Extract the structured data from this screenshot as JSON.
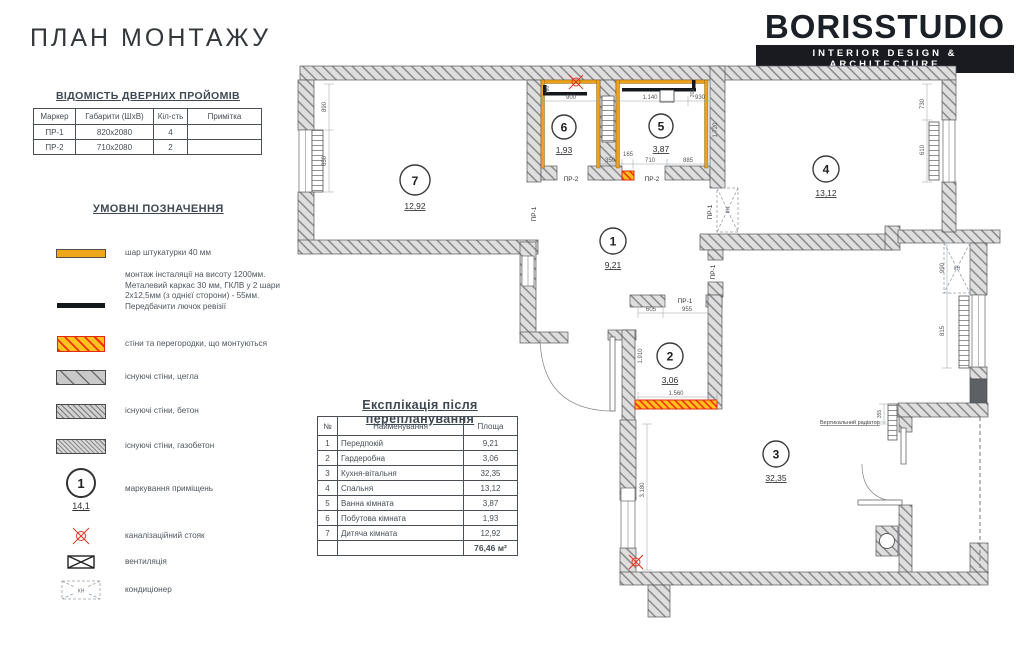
{
  "page": {
    "title": "ПЛАН МОНТАЖУ"
  },
  "logo": {
    "name": "BORISSTUDIO",
    "tagline": "INTERIOR DESIGN & ARCHITECTURE"
  },
  "door_schedule": {
    "title": "ВІДОМІСТЬ ДВЕРНИХ ПРОЙОМІВ",
    "headers": [
      "Маркер",
      "Габарити (ШхВ)",
      "Кіл-сть",
      "Примітка"
    ],
    "rows": [
      {
        "marker": "ПР-1",
        "size": "820х2080",
        "qty": "4",
        "note": ""
      },
      {
        "marker": "ПР-2",
        "size": "710х2080",
        "qty": "2",
        "note": ""
      }
    ]
  },
  "legend": {
    "title": "УМОВНІ ПОЗНАЧЕННЯ",
    "items": [
      {
        "label": "шар штукатурки 40 мм"
      },
      {
        "label": "монтаж інсталяції на висоту 1200мм. Металевий каркас 30 мм, ГКЛВ у 2 шари 2х12,5мм (з однієї сторони) - 55мм.  Передбачити лючок ревізії"
      },
      {
        "label": "стіни та перегородки, що монтуються"
      },
      {
        "label": "існуючі стіни, цегла"
      },
      {
        "label": "існуючі стіни, бетон"
      },
      {
        "label": "існуючі стіни, газобетон"
      },
      {
        "label": "маркування приміщень",
        "sample_number": "1",
        "sample_area": "14,1"
      },
      {
        "label": "каналізаційний стояк"
      },
      {
        "label": "вентиляція"
      },
      {
        "label": "кондиціонер",
        "symbol_text": "КН"
      }
    ]
  },
  "explication": {
    "title": "Експлікація після перепланування",
    "headers": [
      "№",
      "Найменування",
      "Площа"
    ],
    "rows": [
      {
        "n": "1",
        "name": "Передпокій",
        "area": "9,21"
      },
      {
        "n": "2",
        "name": "Гардеробна",
        "area": "3,06"
      },
      {
        "n": "3",
        "name": "Кухня-вітальня",
        "area": "32,35"
      },
      {
        "n": "4",
        "name": "Спальня",
        "area": "13,12"
      },
      {
        "n": "5",
        "name": "Ванна кімната",
        "area": "3,87"
      },
      {
        "n": "6",
        "name": "Побутова кімната",
        "area": "1,93"
      },
      {
        "n": "7",
        "name": "Дитяча кімната",
        "area": "12,92"
      }
    ],
    "total": "76,46 м²"
  },
  "plan": {
    "rooms": [
      {
        "number": "1",
        "area": "9,21"
      },
      {
        "number": "2",
        "area": "3,06"
      },
      {
        "number": "3",
        "area": "32,35"
      },
      {
        "number": "4",
        "area": "13,12"
      },
      {
        "number": "5",
        "area": "3,87"
      },
      {
        "number": "6",
        "area": "1,93"
      },
      {
        "number": "7",
        "area": "12,92"
      }
    ],
    "door_marks": {
      "pr1": "ПР-1",
      "pr2": "ПР-2"
    },
    "dims": {
      "w890": "890",
      "w650": "650",
      "w900": "900",
      "w160": "160",
      "w1140": "1.140",
      "w930": "930",
      "w200": "200",
      "w1720": "1.720",
      "w350": "350",
      "w165": "165",
      "w710": "710",
      "w885": "885",
      "w605": "605",
      "w955": "955",
      "w1910": "1.910",
      "w1560": "1.560",
      "w730": "730",
      "w610": "610",
      "w990": "990",
      "w815": "815",
      "w3180": "3.180",
      "w355": "355"
    },
    "annotations": {
      "vertical_radiator": "Вертикальний радіатор",
      "ac_label": "КН"
    }
  },
  "colors": {
    "accent_plaster": "#f0a61b",
    "accent_new_wall": "#ffc21e",
    "accent_red": "#e8321e",
    "wall_gray": "#c9c9c9",
    "logo_bar": "#191b20"
  }
}
